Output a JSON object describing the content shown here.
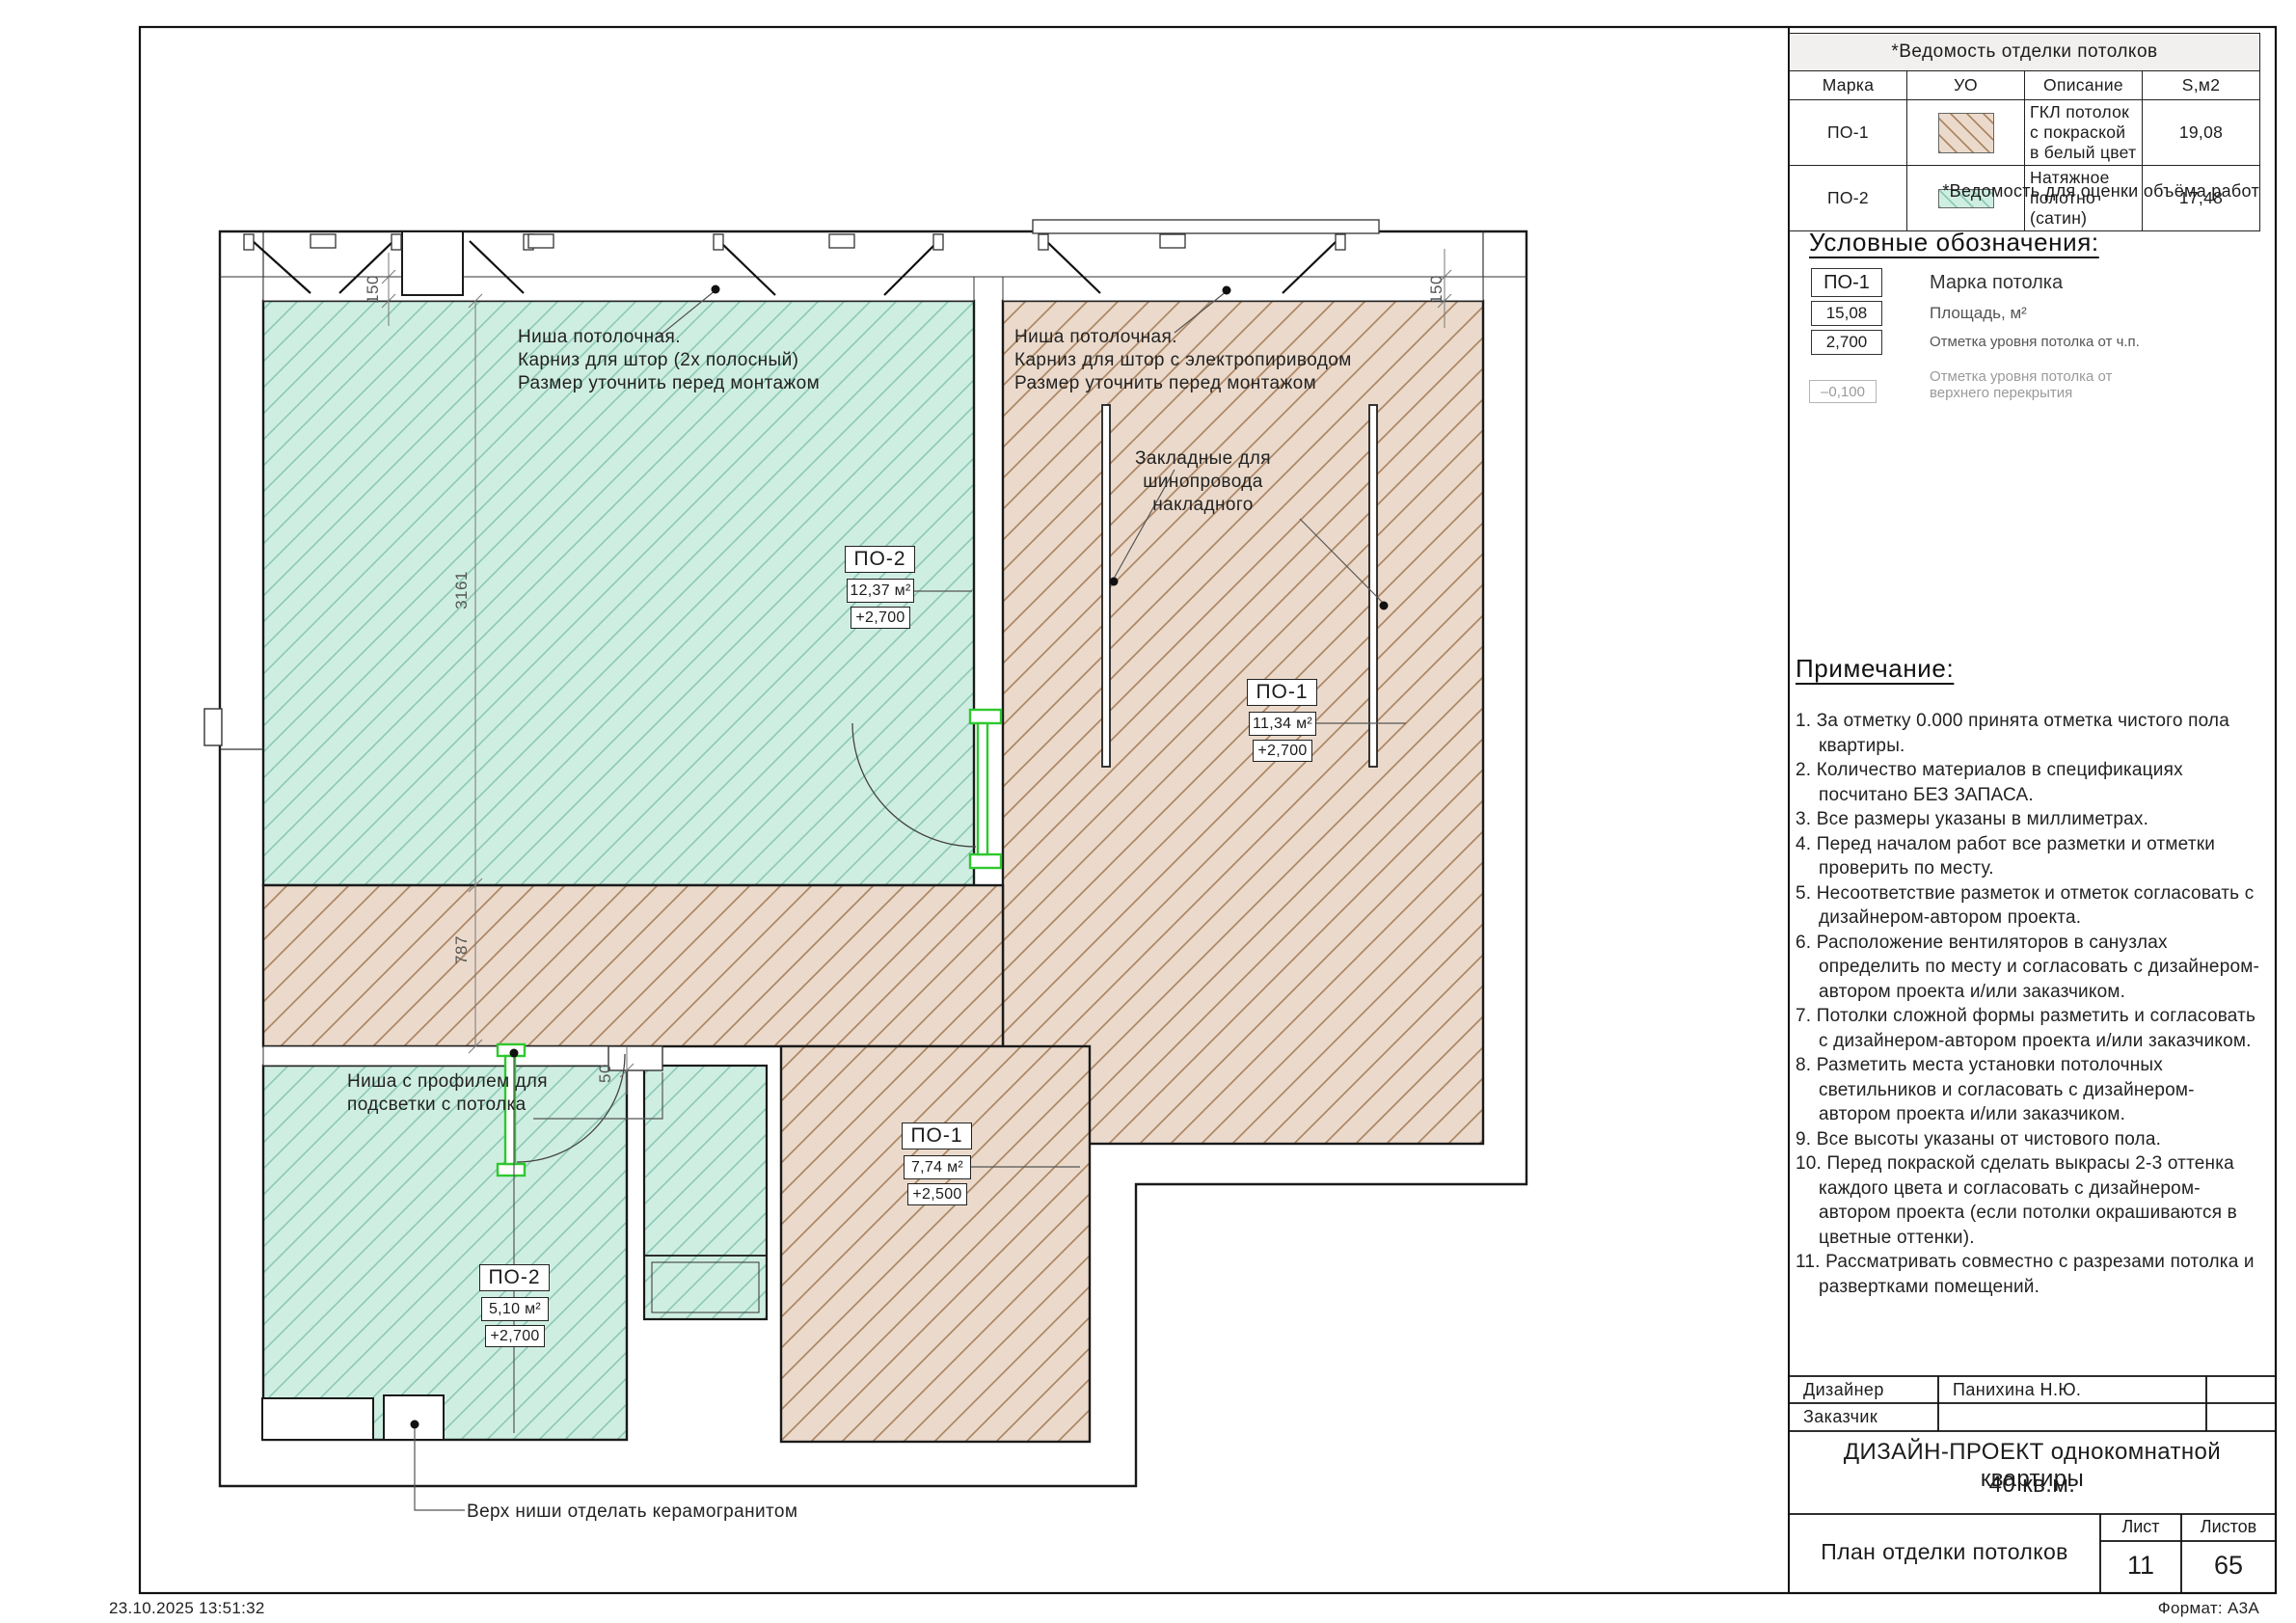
{
  "sheet": {
    "timestamp": "23.10.2025 13:51:32",
    "format": "Формат: А3А"
  },
  "finish_table": {
    "title": "*Ведомость отделки потолков",
    "col_mark": "Марка",
    "col_symbol": "УО",
    "col_desc": "Описание",
    "col_area": "S,м2",
    "rows": [
      {
        "mark": "ПО-1",
        "swatch": "gkl-brown-hatch",
        "desc": "ГКЛ потолок с покраской в белый цвет",
        "area": "19,08"
      },
      {
        "mark": "ПО-2",
        "swatch": "stretch-teal-hatch",
        "desc": "Натяжное полотно (сатин)",
        "area": "17,48"
      }
    ],
    "footnote": "*Ведомость для оценки объёма работ"
  },
  "legend": {
    "title": "Условные обозначения:",
    "item_mark": {
      "symbol": "ПО-1",
      "label": "Марка потолка"
    },
    "item_area": {
      "symbol": "15,08",
      "label": "Площадь, м²"
    },
    "item_level": {
      "symbol": "2,700",
      "label": "Отметка уровня потолка от ч.п."
    },
    "item_slab": {
      "symbol": "–0,100",
      "label_line1": "Отметка уровня потолка от",
      "label_line2": "верхнего перекрытия"
    }
  },
  "notes": {
    "title": "Примечание:",
    "items": [
      "За отметку 0.000 принята отметка чистого пола квартиры.",
      "Количество материалов в спецификациях посчитано БЕЗ ЗАПАСА.",
      "Все размеры указаны в миллиметрах.",
      "Перед началом работ все разметки и отметки проверить по месту.",
      "Несоответствие разметок и отметок согласовать с дизайнером-автором проекта.",
      "Расположение вентиляторов в санузлах определить по месту и согласовать с дизайнером-автором проекта и/или заказчиком.",
      "Потолки сложной формы разметить и согласовать с дизайнером-автором проекта и/или заказчиком.",
      "Разметить места установки потолочных светильников и согласовать с дизайнером-автором проекта и/или заказчиком.",
      "Все высоты указаны от чистового пола.",
      "Перед покраской сделать выкрасы 2-3 оттенка каждого цвета и согласовать с дизайнером-автором проекта (если потолки окрашиваются в цветные оттенки).",
      "Рассматривать совместно с разрезами потолка и развертками помещений."
    ]
  },
  "title_block": {
    "designer_label": "Дизайнер",
    "designer_value": "Панихина Н.Ю.",
    "client_label": "Заказчик",
    "client_value": "",
    "project_line1": "ДИЗАЙН-ПРОЕКТ однокомнатной квартиры",
    "project_line2": "40 кв.м.",
    "drawing_title": "План отделки потолков",
    "sheet_label": "Лист",
    "sheet_value": "11",
    "sheets_label": "Листов",
    "sheets_value": "65"
  },
  "plan": {
    "labels": [
      {
        "mark": "ПО-2",
        "area": "12,37 м²",
        "level": "+2,700"
      },
      {
        "mark": "ПО-1",
        "area": "11,34 м²",
        "level": "+2,700"
      },
      {
        "mark": "ПО-1",
        "area": "7,74 м²",
        "level": "+2,500"
      },
      {
        "mark": "ПО-2",
        "area": "5,10 м²",
        "level": "+2,700"
      }
    ],
    "annotations": {
      "niche_left_1": "Ниша потолочная.",
      "niche_left_2": "Карниз для штор (2х полосный)",
      "niche_left_3": "Размер уточнить перед монтажом",
      "niche_right_1": "Ниша потолочная.",
      "niche_right_2": "Карниз для штор с электропириводом",
      "niche_right_3": "Размер уточнить перед монтажом",
      "busbar_1": "Закладные для",
      "busbar_2": "шинопровода",
      "busbar_3": "накладного",
      "light_niche_1": "Ниша с профилем для",
      "light_niche_2": "подсветки с потолка",
      "ceramic": "Верх ниши отделать керамогранитом"
    },
    "dimensions": {
      "room_height": "3161",
      "corridor": "787",
      "niche_top": "150",
      "niche_right": "150",
      "light_niche": "50"
    },
    "colors": {
      "stretch_bg": "#cfeee2",
      "stretch_line": "#8cc9b6",
      "gkl_bg": "#ebdacb",
      "gkl_line": "#ad8766",
      "door": "#2ec82e"
    }
  }
}
